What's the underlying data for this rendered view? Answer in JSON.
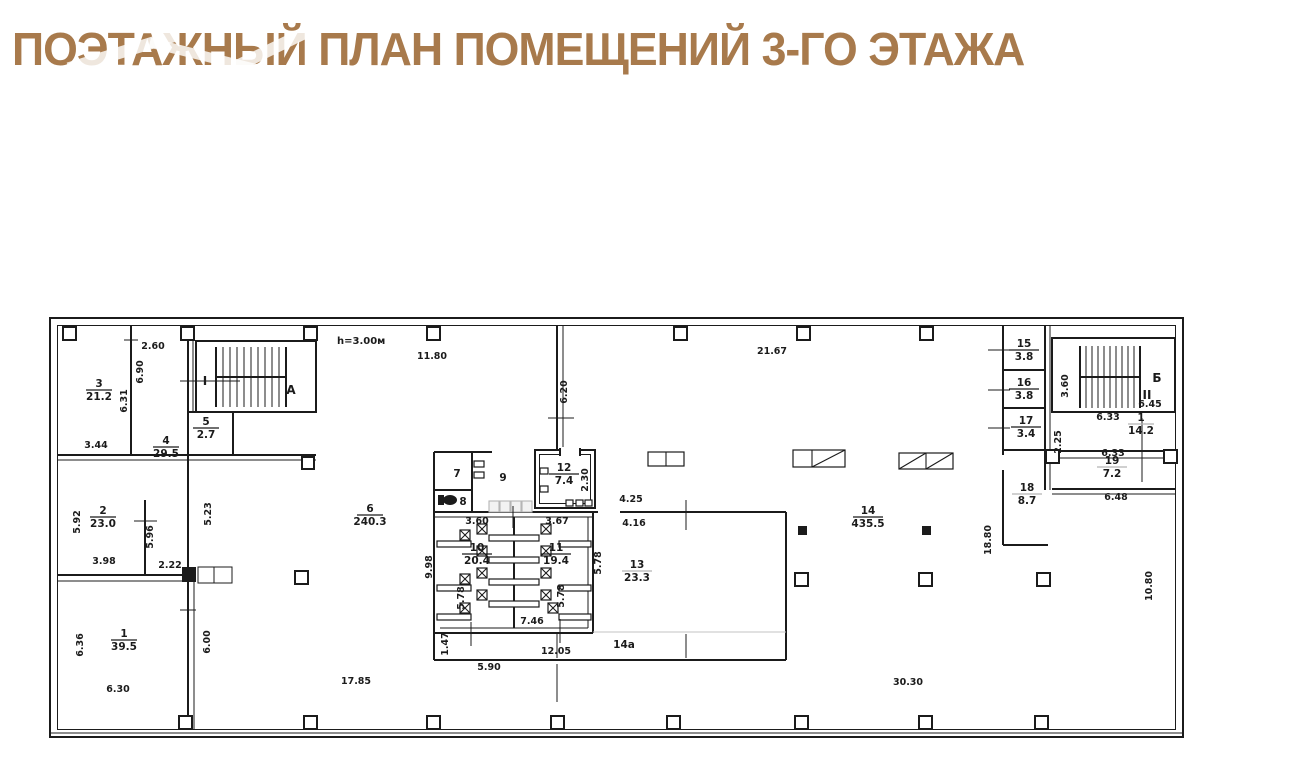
{
  "title": "ПОЭТАЖНЫЙ ПЛАН ПОМЕЩЕНИЙ 3-ГО ЭТАЖА",
  "plan": {
    "note": "h=3.00м",
    "colors": {
      "wall": "#1b1b1b",
      "gray_label": "#b5b5b5",
      "title": "#a87a4c"
    },
    "rooms": [
      {
        "num": "1",
        "area": "39.5",
        "x": 124,
        "y": 637
      },
      {
        "num": "2",
        "area": "23.0",
        "x": 103,
        "y": 514
      },
      {
        "num": "3",
        "area": "21.2",
        "x": 99,
        "y": 387
      },
      {
        "num": "4",
        "area": "29.5",
        "x": 166,
        "y": 444
      },
      {
        "num": "5",
        "area": "2.7",
        "x": 206,
        "y": 425
      },
      {
        "num": "6",
        "area": "240.3",
        "x": 370,
        "y": 512
      },
      {
        "num": "7",
        "area": null,
        "x": 457,
        "y": 477
      },
      {
        "num": "8",
        "area": null,
        "x": 463,
        "y": 505
      },
      {
        "num": "9",
        "area": null,
        "x": 503,
        "y": 481,
        "gray": true
      },
      {
        "num": "10",
        "area": "20.4",
        "x": 477,
        "y": 551
      },
      {
        "num": "11",
        "area": "19.4",
        "x": 556,
        "y": 551
      },
      {
        "num": "12",
        "area": "7.4",
        "x": 564,
        "y": 471
      },
      {
        "num": "13",
        "area": "23.3",
        "x": 637,
        "y": 568,
        "gray": true
      },
      {
        "num": "14",
        "area": "435.5",
        "x": 868,
        "y": 514
      },
      {
        "num": "14а",
        "area": null,
        "x": 624,
        "y": 648,
        "gray": true
      },
      {
        "num": "15",
        "area": "3.8",
        "x": 1024,
        "y": 347
      },
      {
        "num": "16",
        "area": "3.8",
        "x": 1024,
        "y": 386
      },
      {
        "num": "17",
        "area": "3.4",
        "x": 1026,
        "y": 424
      },
      {
        "num": "18",
        "area": "8.7",
        "x": 1027,
        "y": 491,
        "gray": true
      },
      {
        "num": "1",
        "area": "14.2",
        "x": 1141,
        "y": 421,
        "gray": true
      },
      {
        "num": "19",
        "area": "7.2",
        "x": 1112,
        "y": 464,
        "gray": true
      }
    ],
    "zone_letters": [
      {
        "t": "А",
        "x": 291,
        "y": 394
      },
      {
        "t": "Б",
        "x": 1157,
        "y": 382
      },
      {
        "t": "I",
        "x": 205,
        "y": 385
      },
      {
        "t": "II",
        "x": 1147,
        "y": 399
      }
    ],
    "dims": [
      {
        "t": "2.60",
        "x": 153,
        "y": 349
      },
      {
        "t": "6.90",
        "x": 143,
        "y": 372,
        "rot": true
      },
      {
        "t": "6.31",
        "x": 127,
        "y": 401,
        "rot": true
      },
      {
        "t": "3.44",
        "x": 96,
        "y": 448
      },
      {
        "t": "5.92",
        "x": 80,
        "y": 522,
        "rot": true
      },
      {
        "t": "3.98",
        "x": 104,
        "y": 564
      },
      {
        "t": "5.96",
        "x": 153,
        "y": 537,
        "rot": true
      },
      {
        "t": "2.22",
        "x": 170,
        "y": 568
      },
      {
        "t": "5.23",
        "x": 211,
        "y": 514,
        "rot": true
      },
      {
        "t": "6.36",
        "x": 83,
        "y": 645,
        "rot": true
      },
      {
        "t": "6.30",
        "x": 118,
        "y": 692
      },
      {
        "t": "6.00",
        "x": 210,
        "y": 642,
        "rot": true
      },
      {
        "t": "17.85",
        "x": 356,
        "y": 684
      },
      {
        "t": "11.80",
        "x": 432,
        "y": 359
      },
      {
        "t": "21.67",
        "x": 772,
        "y": 354
      },
      {
        "t": "6.20",
        "x": 567,
        "y": 392,
        "rot": true
      },
      {
        "t": "2.30",
        "x": 588,
        "y": 480,
        "rot": true
      },
      {
        "t": "3.60",
        "x": 477,
        "y": 524
      },
      {
        "t": "3.67",
        "x": 557,
        "y": 524
      },
      {
        "t": "4.25",
        "x": 631,
        "y": 502
      },
      {
        "t": "4.16",
        "x": 634,
        "y": 526
      },
      {
        "t": "9.98",
        "x": 432,
        "y": 567,
        "rot": true
      },
      {
        "t": "5.78",
        "x": 464,
        "y": 598,
        "rot": true
      },
      {
        "t": "5.78",
        "x": 564,
        "y": 596,
        "rot": true
      },
      {
        "t": "5.78",
        "x": 601,
        "y": 563,
        "rot": true
      },
      {
        "t": "7.46",
        "x": 532,
        "y": 624
      },
      {
        "t": "1.47",
        "x": 448,
        "y": 644,
        "rot": true
      },
      {
        "t": "12.05",
        "x": 556,
        "y": 654
      },
      {
        "t": "5.90",
        "x": 489,
        "y": 670
      },
      {
        "t": "30.30",
        "x": 908,
        "y": 685
      },
      {
        "t": "10.80",
        "x": 1152,
        "y": 586,
        "rot": true
      },
      {
        "t": "18.80",
        "x": 991,
        "y": 540,
        "rot": true
      },
      {
        "t": "3.60",
        "x": 1068,
        "y": 386,
        "rot": true
      },
      {
        "t": "6.45",
        "x": 1150,
        "y": 407
      },
      {
        "t": "6.33",
        "x": 1108,
        "y": 420
      },
      {
        "t": "6.33",
        "x": 1113,
        "y": 456
      },
      {
        "t": "6.48",
        "x": 1116,
        "y": 500
      },
      {
        "t": "2.25",
        "x": 1061,
        "y": 442,
        "rot": true
      }
    ]
  }
}
